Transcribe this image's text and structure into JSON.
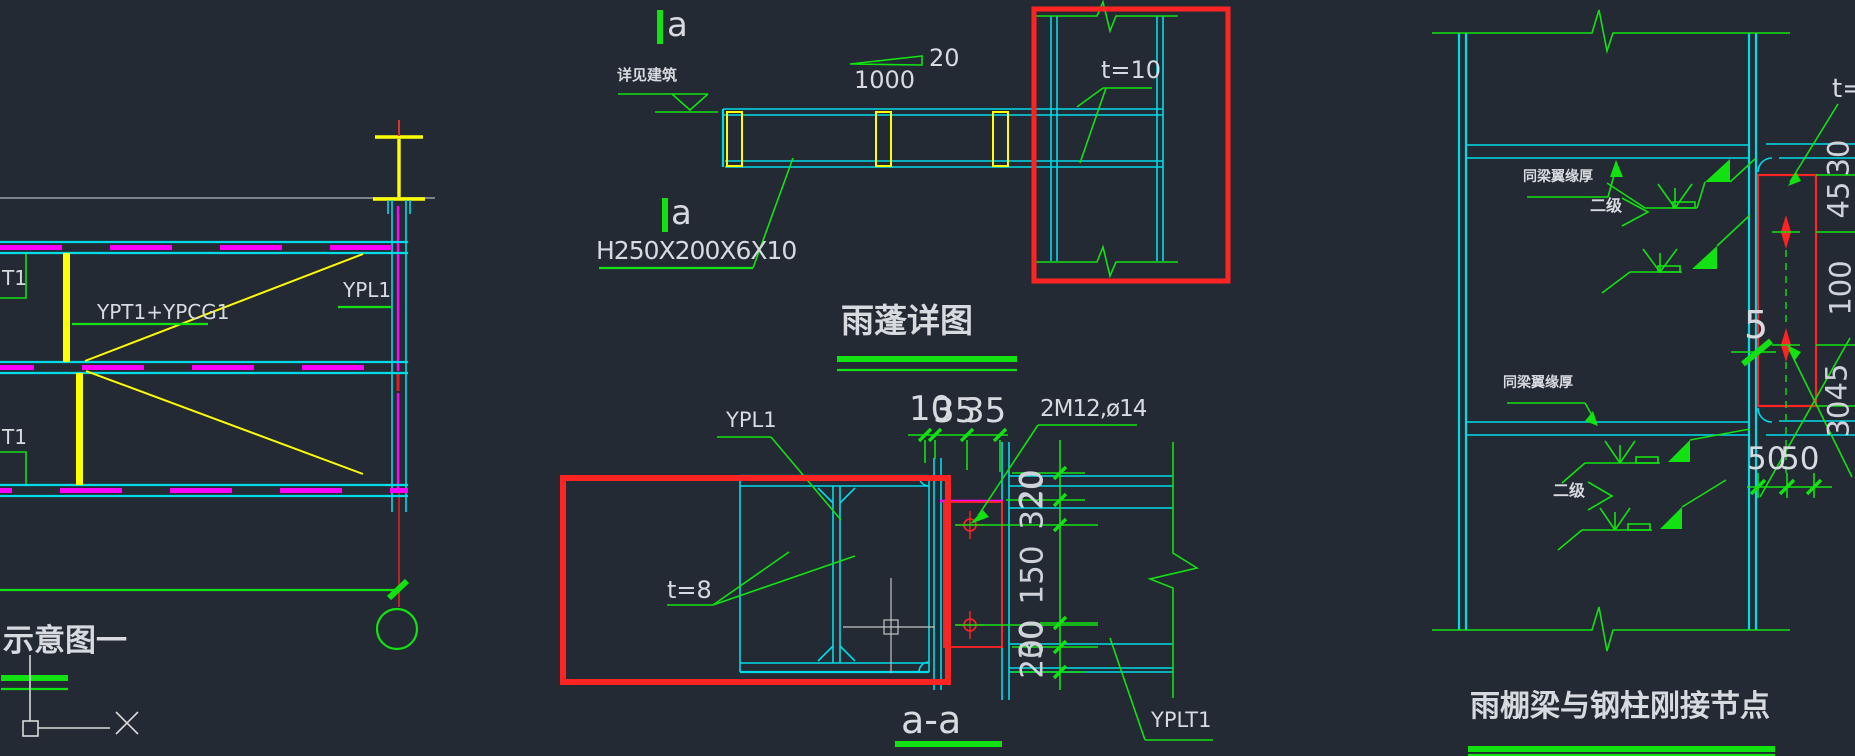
{
  "colors": {
    "background": "#242a34",
    "cyan": "#00dbe8",
    "green": "#12e112",
    "yellow": "#ffff00",
    "magenta": "#ff00ff",
    "red": "#ff2424",
    "text": "#d7dadf",
    "gray_line": "#7c828c"
  },
  "plan": {
    "member_label": "T1",
    "girder_label": "YPT1+YPCG1",
    "plate_label": "YPL1",
    "caption": "示意图一"
  },
  "elevation": {
    "section_mark": "a",
    "datum_note": "详见建筑",
    "slope": "20",
    "length": "1000",
    "plate_thickness": "t=10",
    "beam_spec": "H250X200X6X10",
    "title": "雨蓬详图"
  },
  "section": {
    "plate_label": "YPL1",
    "web_thickness": "t=8",
    "bolt_note": "2M12,ø14",
    "dim_10": "10",
    "dim_35": "35",
    "dim_320": "320",
    "dim_20": "20",
    "dim_150": "150",
    "dim_200": "200",
    "dim_30": "30",
    "edge_plate_label": "YPLT1",
    "title": "a-a"
  },
  "node": {
    "flange_note": "同梁翼缘厚",
    "weld_grade": "二级",
    "weld_size": "5",
    "thickness_partial": "t=",
    "dim_30": "30",
    "dim_45": "45",
    "dim_100": "100",
    "dim_50": "50",
    "title": "雨棚梁与钢柱刚接节点"
  }
}
